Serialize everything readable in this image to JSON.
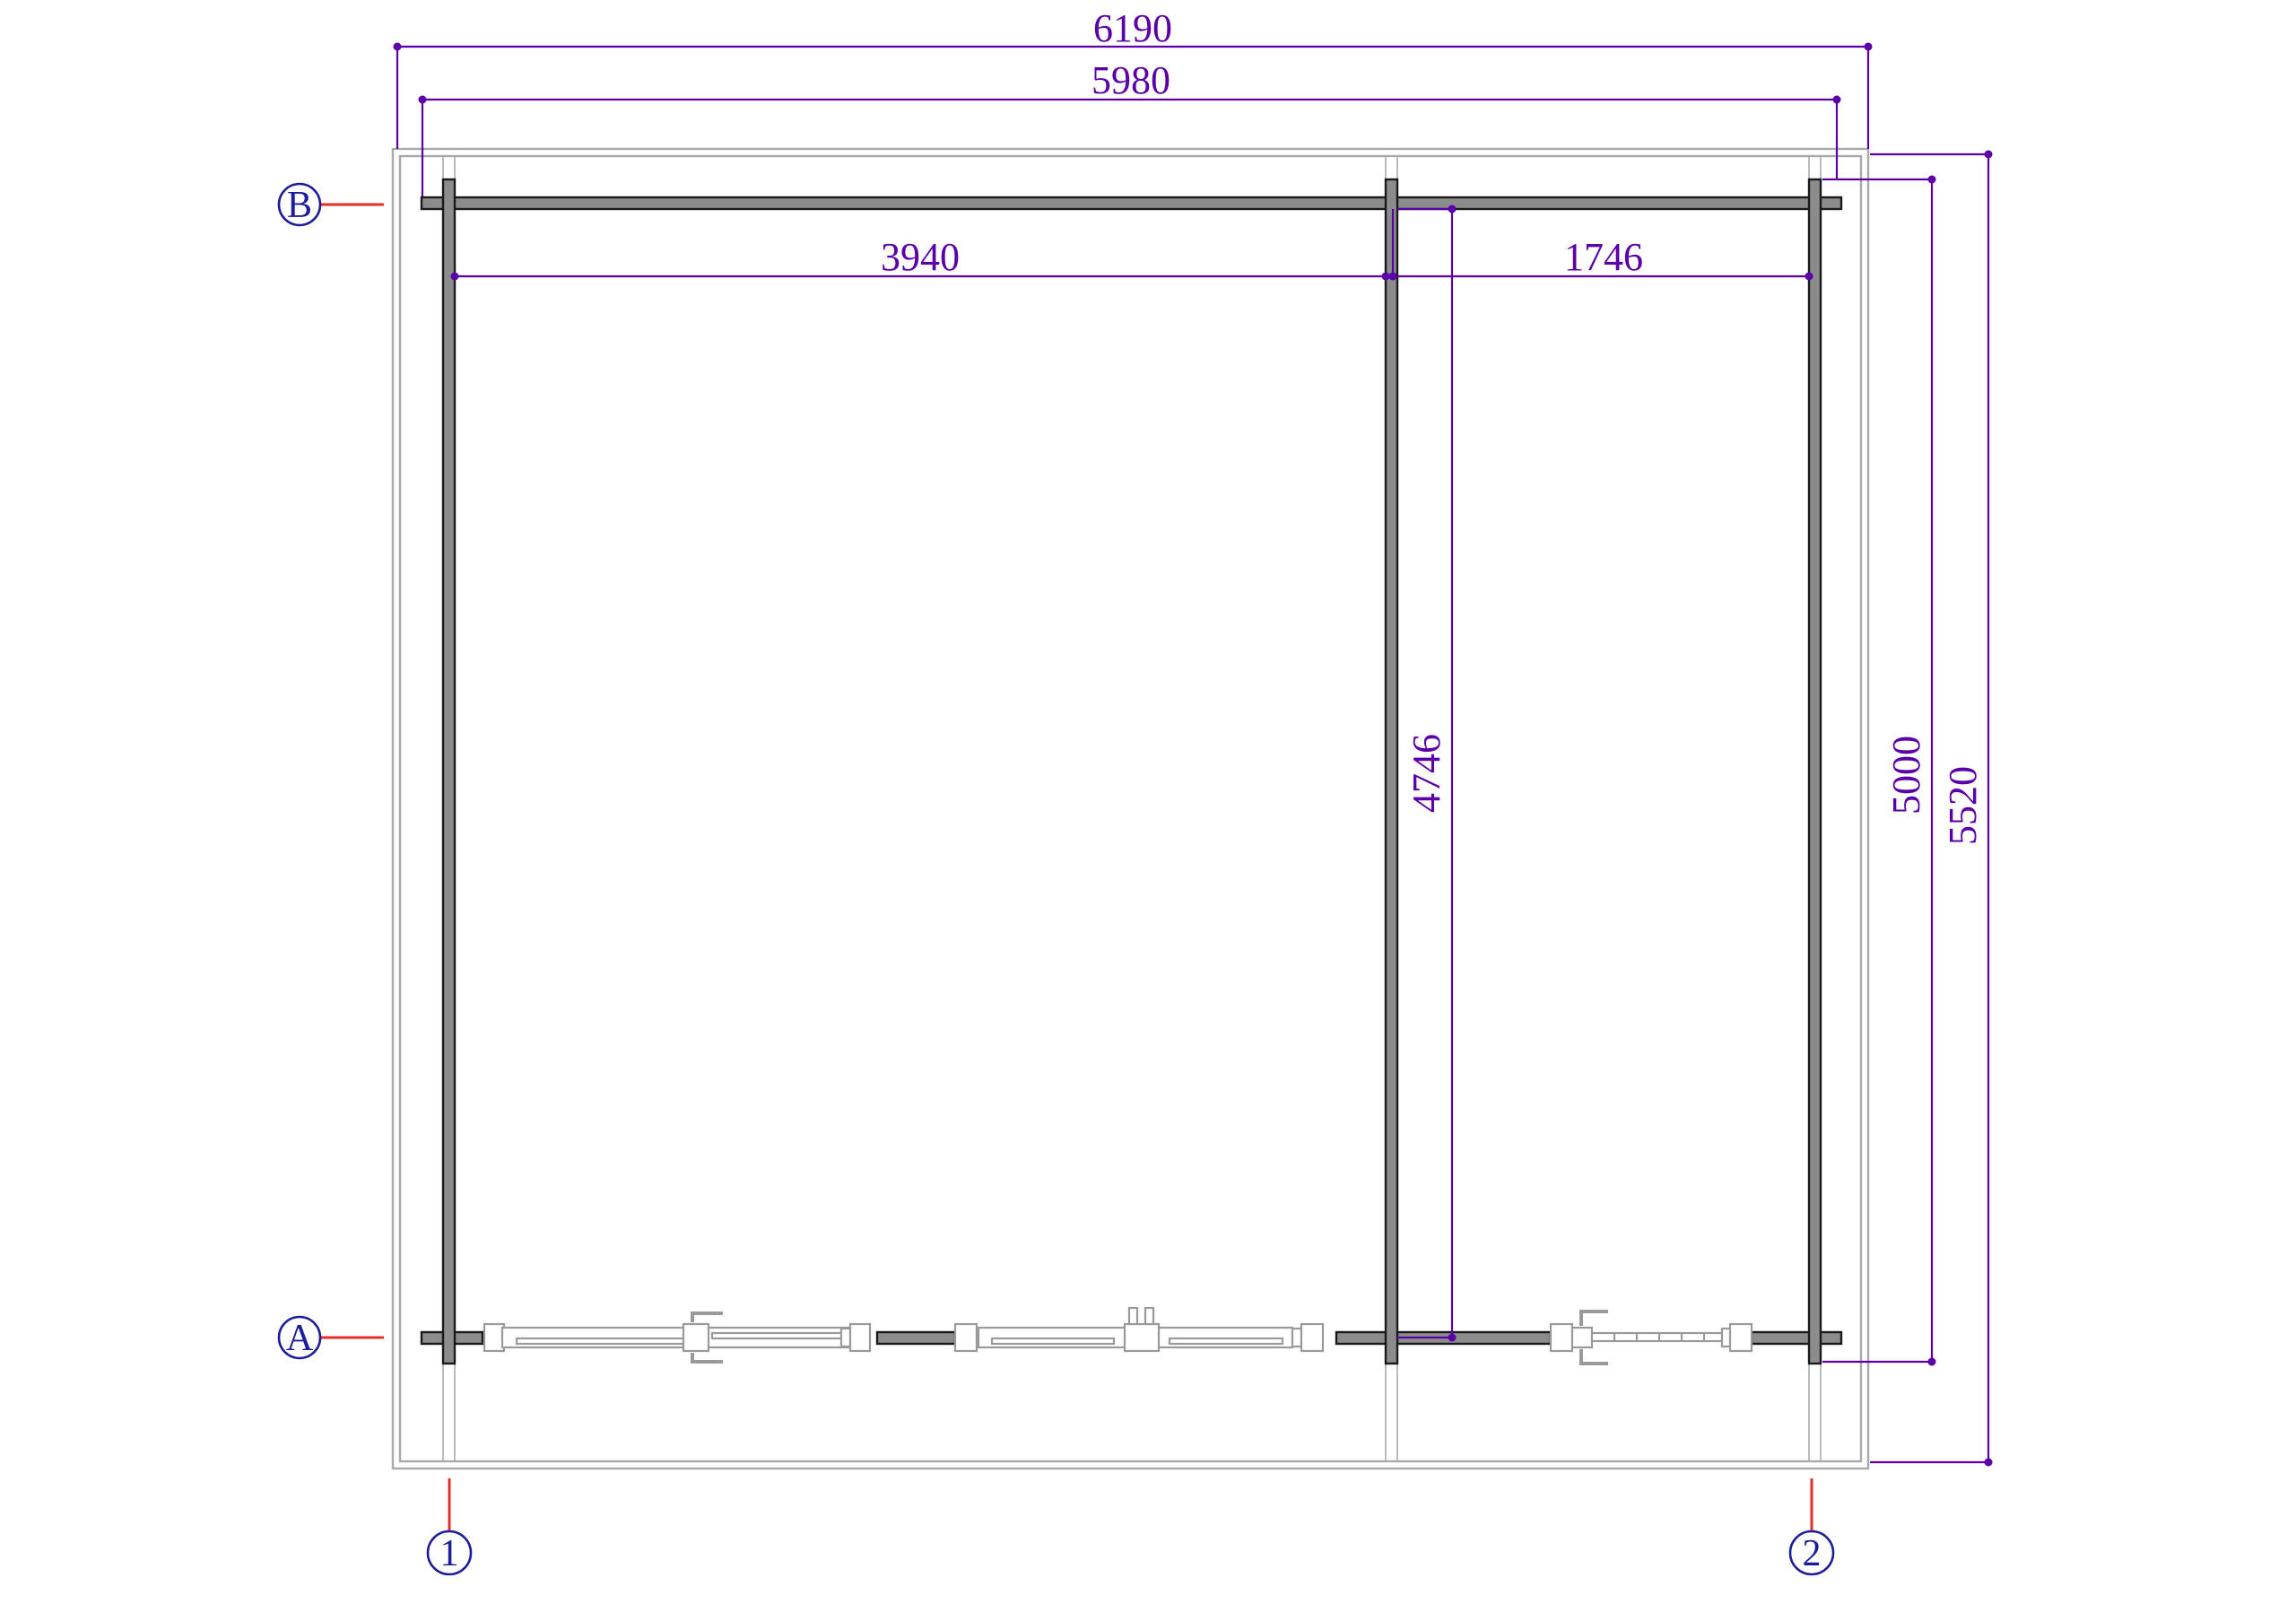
{
  "drawing": {
    "title": "log-cabin-floor-plan",
    "dimensions": {
      "roof_width": "6190",
      "wall_width": "5980",
      "left_room_width": "3940",
      "right_room_width": "1746",
      "interior_depth": "4746",
      "wall_depth": "5000",
      "roof_depth": "5520"
    },
    "grid_markers": {
      "row_b": "B",
      "row_a": "A",
      "col_1": "1",
      "col_2": "2"
    },
    "colors": {
      "dimension_purple": "#5b00a8",
      "grid_navy": "#1c1c9c",
      "leader_red": "#e3302a",
      "wall_fill": "#8c8c8c",
      "wall_outline": "#1a1a1a",
      "roof_gray": "#a8a8a8",
      "glazing_gray": "#9a9a9a"
    }
  }
}
